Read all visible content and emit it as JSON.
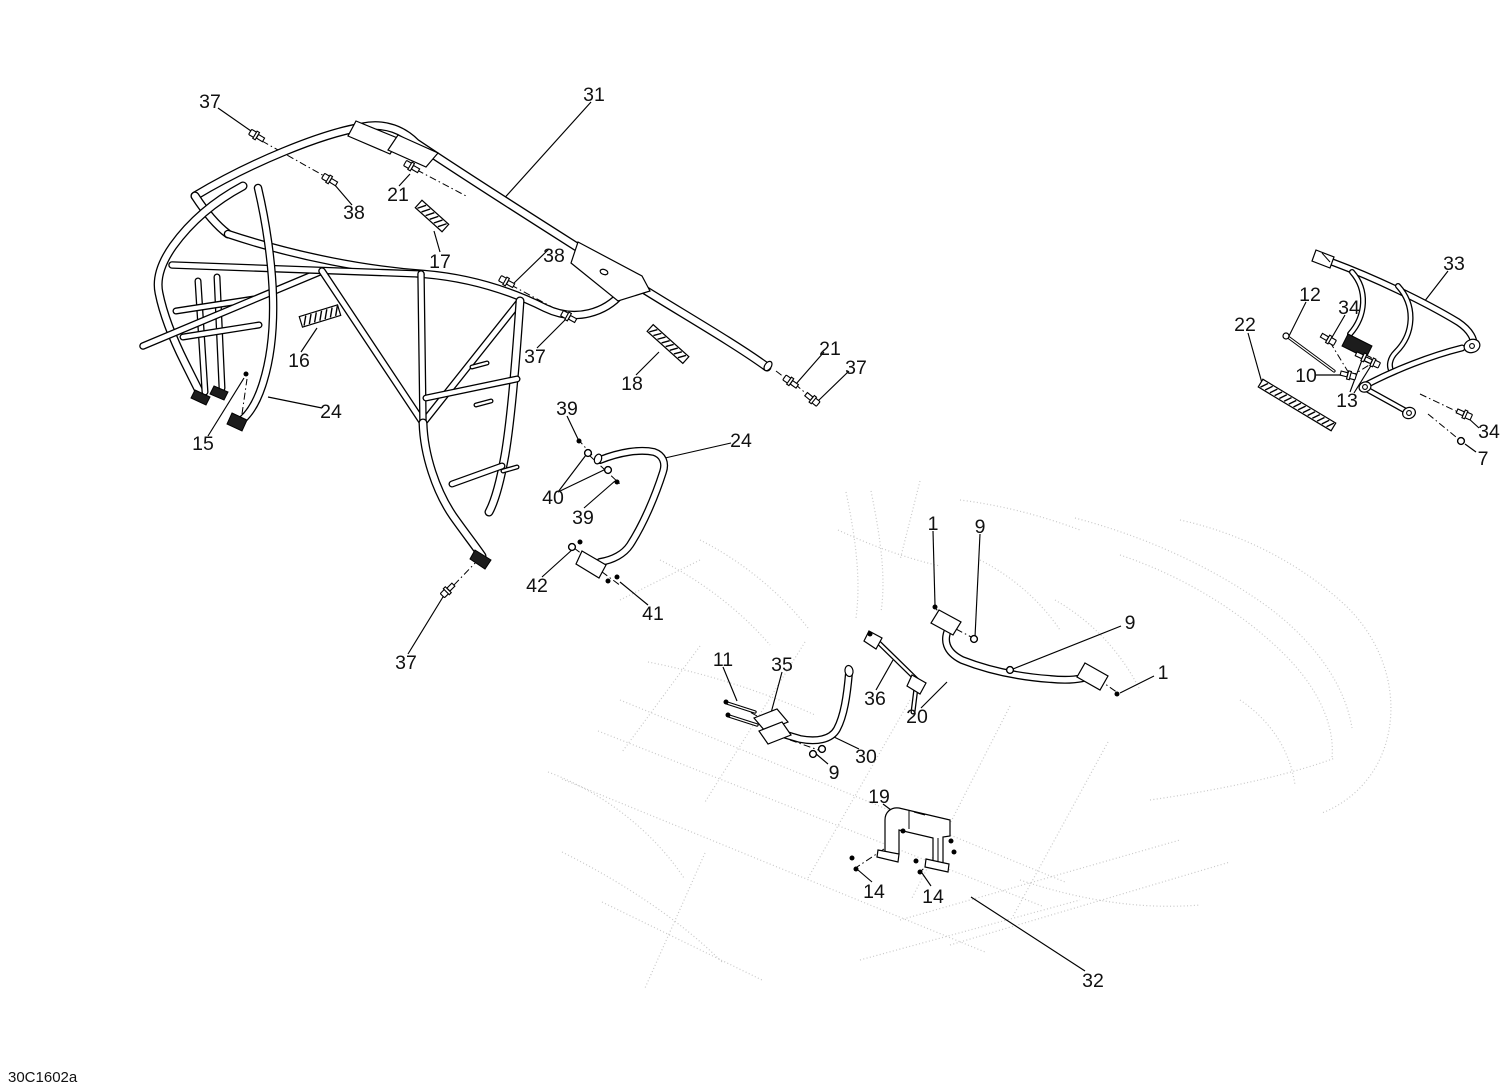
{
  "page": {
    "background_color": "#ffffff",
    "line_color": "#000000",
    "ghost_sketch_color": "#c2c2c2"
  },
  "diagram": {
    "drawing_code": "30C1602a",
    "callouts": [
      {
        "text": "37",
        "x": 210,
        "y": 101
      },
      {
        "text": "31",
        "x": 594,
        "y": 94
      },
      {
        "text": "38",
        "x": 354,
        "y": 212
      },
      {
        "text": "21",
        "x": 398,
        "y": 194
      },
      {
        "text": "17",
        "x": 440,
        "y": 261
      },
      {
        "text": "38",
        "x": 554,
        "y": 255
      },
      {
        "text": "16",
        "x": 299,
        "y": 360
      },
      {
        "text": "37",
        "x": 535,
        "y": 356
      },
      {
        "text": "18",
        "x": 632,
        "y": 383
      },
      {
        "text": "21",
        "x": 830,
        "y": 348
      },
      {
        "text": "37",
        "x": 856,
        "y": 367
      },
      {
        "text": "24",
        "x": 331,
        "y": 411
      },
      {
        "text": "15",
        "x": 203,
        "y": 443
      },
      {
        "text": "39",
        "x": 567,
        "y": 408
      },
      {
        "text": "24",
        "x": 741,
        "y": 440
      },
      {
        "text": "40",
        "x": 553,
        "y": 497
      },
      {
        "text": "39",
        "x": 583,
        "y": 517
      },
      {
        "text": "42",
        "x": 537,
        "y": 585
      },
      {
        "text": "41",
        "x": 653,
        "y": 613
      },
      {
        "text": "37",
        "x": 406,
        "y": 662
      },
      {
        "text": "11",
        "x": 723,
        "y": 659
      },
      {
        "text": "35",
        "x": 782,
        "y": 664
      },
      {
        "text": "1",
        "x": 933,
        "y": 523
      },
      {
        "text": "9",
        "x": 980,
        "y": 526
      },
      {
        "text": "9",
        "x": 1130,
        "y": 622
      },
      {
        "text": "1",
        "x": 1163,
        "y": 672
      },
      {
        "text": "36",
        "x": 875,
        "y": 698
      },
      {
        "text": "20",
        "x": 917,
        "y": 716
      },
      {
        "text": "30",
        "x": 866,
        "y": 756
      },
      {
        "text": "9",
        "x": 834,
        "y": 772
      },
      {
        "text": "19",
        "x": 879,
        "y": 796
      },
      {
        "text": "14",
        "x": 874,
        "y": 891
      },
      {
        "text": "14",
        "x": 933,
        "y": 896
      },
      {
        "text": "32",
        "x": 1093,
        "y": 980
      },
      {
        "text": "33",
        "x": 1454,
        "y": 263
      },
      {
        "text": "12",
        "x": 1310,
        "y": 294
      },
      {
        "text": "34",
        "x": 1349,
        "y": 307
      },
      {
        "text": "22",
        "x": 1245,
        "y": 324
      },
      {
        "text": "10",
        "x": 1306,
        "y": 375
      },
      {
        "text": "13",
        "x": 1347,
        "y": 400
      },
      {
        "text": "34",
        "x": 1489,
        "y": 431
      },
      {
        "text": "7",
        "x": 1483,
        "y": 458
      }
    ]
  }
}
